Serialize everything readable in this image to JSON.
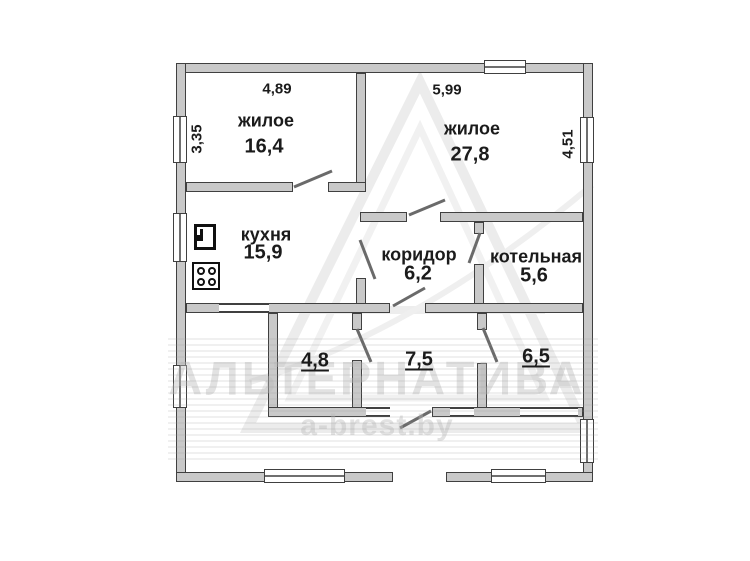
{
  "plan": {
    "rooms": [
      {
        "name": "жилое",
        "area": "16,4"
      },
      {
        "name": "жилое",
        "area": "27,8"
      },
      {
        "name": "кухня",
        "area": "15,9"
      },
      {
        "name": "коридор",
        "area": "6,2"
      },
      {
        "name": "котельная",
        "area": "5,6"
      },
      {
        "area": "4,8"
      },
      {
        "area": "7,5"
      },
      {
        "area": "6,5"
      }
    ],
    "dimensions": {
      "room1_width": "4,89",
      "room1_height": "3,35",
      "room2_width": "5,99",
      "room2_height": "4,51"
    },
    "icons": {
      "fridge": "fridge-icon",
      "stove": "stove-icon"
    }
  },
  "watermark": {
    "brand": "АЛЬТЕРНАТИВА",
    "site": "a-brest.by"
  }
}
